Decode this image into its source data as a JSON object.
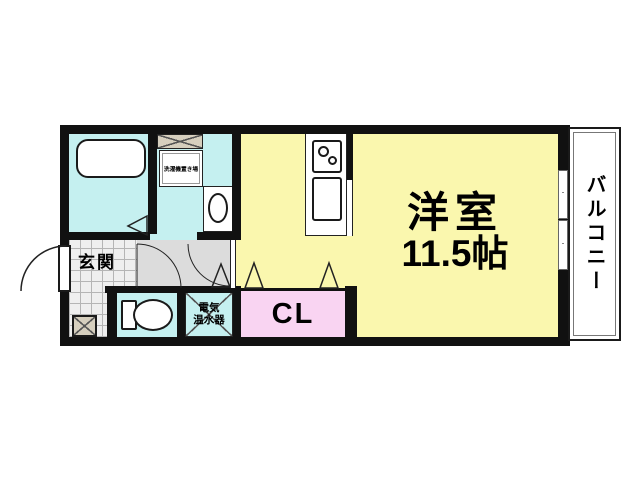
{
  "floorplan": {
    "main_room": {
      "label": "洋室",
      "size": "11.5帖"
    },
    "balcony": {
      "label": "バルコニー"
    },
    "entrance": {
      "label": "玄関"
    },
    "closet": {
      "label": "CL"
    },
    "water_heater": {
      "label_line1": "電気",
      "label_line2": "温水器"
    },
    "laundry_space": {
      "label": "洗濯機置き場"
    },
    "colors": {
      "room_yellow": "#FAF7AE",
      "wet_area_cyan": "#C5F0F0",
      "closet_pink": "#F9D4F2",
      "hallway_gray": "#DCDCDC",
      "storage_beige": "#D6CFBE",
      "wall_black": "#111111",
      "balcony_white": "#FFFFFF"
    }
  }
}
